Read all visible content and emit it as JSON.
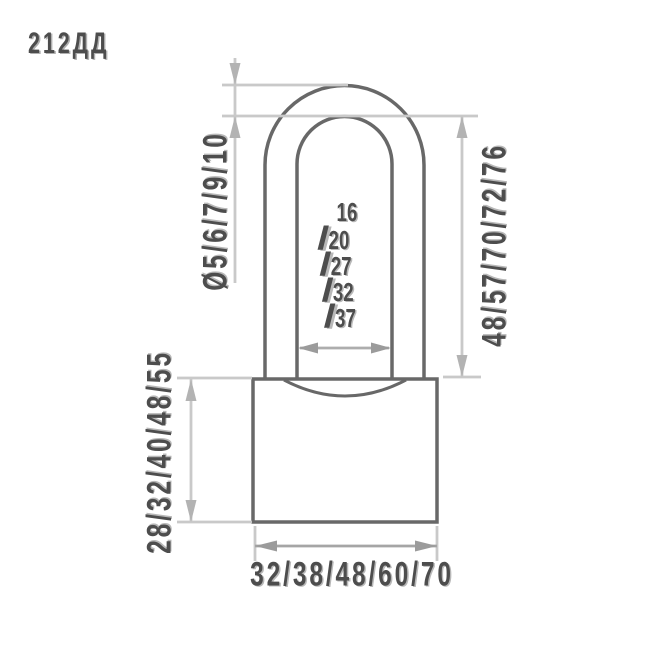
{
  "title": "212ДД",
  "figure": "padlock-technical-drawing",
  "dimensions": {
    "shackle_diameter": {
      "label": "Ø5/6/7/9/10",
      "values": [
        5,
        6,
        7,
        9,
        10
      ]
    },
    "shackle_height": {
      "label": "48/57/70/72/76",
      "values": [
        48,
        57,
        70,
        72,
        76
      ]
    },
    "shackle_inner_width": {
      "values": [
        16,
        20,
        27,
        32,
        37
      ],
      "lines": [
        {
          "slash": "",
          "value": "16"
        },
        {
          "slash": "/",
          "value": "20"
        },
        {
          "slash": "/",
          "value": "27"
        },
        {
          "slash": "/",
          "value": "32"
        },
        {
          "slash": "/",
          "value": "37"
        }
      ]
    },
    "body_height": {
      "label": "28/32/40/48/55",
      "values": [
        28,
        32,
        40,
        48,
        55
      ]
    },
    "body_width": {
      "label": "32/38/48/60/70",
      "values": [
        32,
        38,
        48,
        60,
        70
      ]
    }
  },
  "colors": {
    "background": "#ffffff",
    "outline": "#686868",
    "dimension_line": "#c9c9c9",
    "arrow": "#b3b3b3",
    "arrow_dark": "#9b9b9b",
    "text": "#4d4d4d"
  }
}
